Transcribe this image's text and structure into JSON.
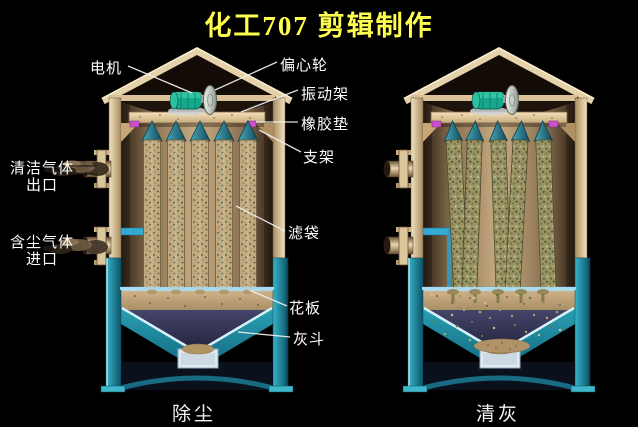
{
  "title": "化工707 剪辑制作",
  "captions": {
    "left": "除尘",
    "right": "清灰"
  },
  "labels": {
    "motor": "电机",
    "eccentric_wheel": "偏心轮",
    "vibration_frame": "振动架",
    "rubber_pad": "橡胶垫",
    "support": "支架",
    "clean_gas_line1": "清洁气体",
    "clean_gas_line2": "出口",
    "dusty_gas_line1": "含尘气体",
    "dusty_gas_line2": "进口",
    "filter_bag": "滤袋",
    "tube_sheet": "花板",
    "ash_hopper": "灰斗"
  },
  "colors": {
    "background": "#000000",
    "title_text": "#ffff4d",
    "label_text": "#ffffff",
    "shell_tan": "#dcc69e",
    "motor_teal": "#17a78c",
    "bag_cone_teal": "#2b7f92",
    "hopper_teal": "#2196ac",
    "funnel_navy": "#3c3c5c",
    "rubber_pad_magenta": "#cc4fcc",
    "dust_olive": "#8a8a58",
    "tube_sheet_blue": "#aadbee"
  }
}
